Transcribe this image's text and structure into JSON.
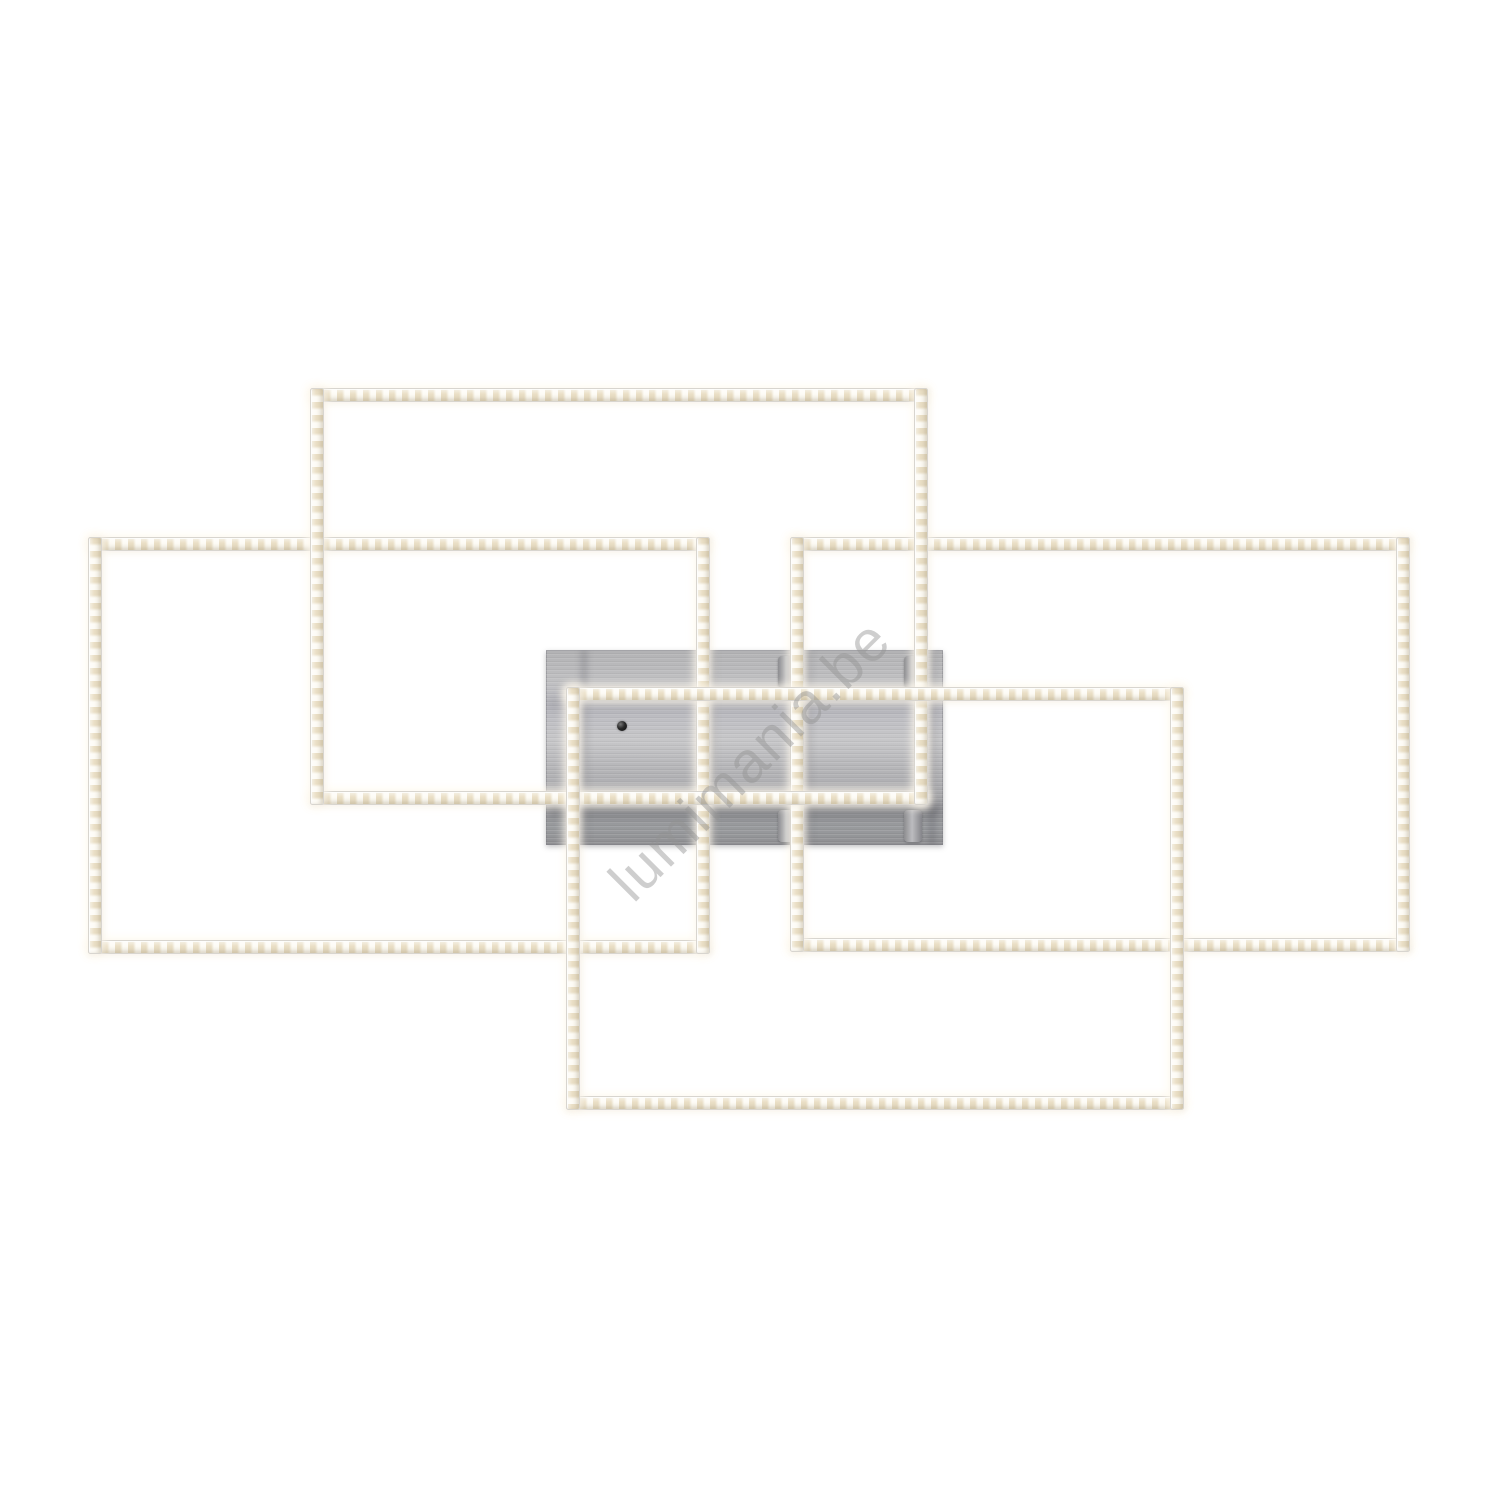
{
  "meta": {
    "image_type": "product-photo",
    "background_color": "#ffffff",
    "subject": "led-frame-ceiling-light"
  },
  "watermark": {
    "text": "lumimania.be",
    "color": "rgba(146,146,146,0.45)",
    "rotation_deg": -45,
    "font_size_px": 58,
    "center": {
      "x": 750,
      "y": 760
    }
  },
  "product": {
    "frame_color": "#f3ecdf",
    "frame_dot_color": "#eadfc6",
    "frame_edge_color": "#d8d5cf",
    "bar_thickness": 14,
    "plate": {
      "x": 546,
      "y": 650,
      "w": 397,
      "h": 195
    },
    "plate_shading": {
      "h_bands": [
        {
          "y": 153,
          "h": 15
        },
        {
          "y": 50,
          "h": 8
        }
      ],
      "v_bands": [
        {
          "x": 34
        },
        {
          "x": 162
        },
        {
          "x": 258
        },
        {
          "x": 382
        }
      ]
    },
    "sensor_dot": {
      "x": 622,
      "y": 726,
      "r": 5
    },
    "standoffs": [
      {
        "x": 778,
        "y": 656
      },
      {
        "x": 904,
        "y": 656
      },
      {
        "x": 778,
        "y": 810
      },
      {
        "x": 904,
        "y": 810
      }
    ],
    "frames": [
      {
        "id": "left",
        "x": 88,
        "y": 537,
        "w": 622,
        "h": 417,
        "z": 1
      },
      {
        "id": "right",
        "x": 790,
        "y": 537,
        "w": 620,
        "h": 415,
        "z": 2
      },
      {
        "id": "top",
        "x": 310,
        "y": 388,
        "w": 618,
        "h": 417,
        "z": 3
      },
      {
        "id": "bottom",
        "x": 566,
        "y": 687,
        "w": 618,
        "h": 423,
        "z": 4
      }
    ]
  }
}
